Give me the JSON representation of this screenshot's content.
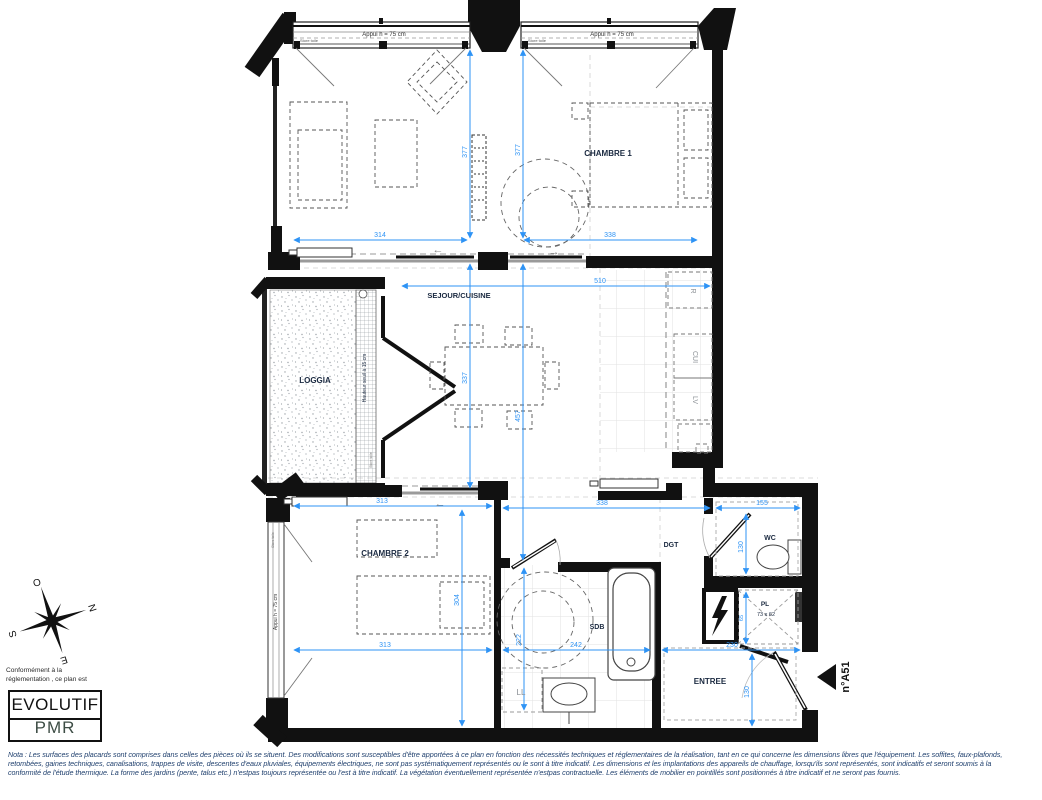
{
  "plan": {
    "marker": "n°A51"
  },
  "rooms": {
    "chambre1": "CHAMBRE 1",
    "sejour": "SEJOUR/CUISINE",
    "loggia": "LOGGIA",
    "chambre2": "CHAMBRE 2",
    "sdb": "SDB",
    "dgt": "DGT",
    "wc": "WC",
    "entree": "ENTREE",
    "placard": "PL",
    "placard_size": "73 x 62"
  },
  "equipment": {
    "fridge": "R",
    "cooktop": "CUI",
    "dishwasher": "LV",
    "washer": "LL"
  },
  "windows": {
    "sill": "Appui h = 75 cm",
    "blind": "Store toile",
    "loggia_threshold": "Hauteur seuil à 15 cm"
  },
  "symbols": {
    "arrow_left": "←",
    "arrow_right": "→"
  },
  "dims": {
    "sejour_part_width": "314",
    "chambre1_width": "338",
    "sejour_part_depth": "377",
    "chambre1_depth": "377",
    "sejour_width": "510",
    "sejour_inner_depth": "337",
    "sejour_depth": "457",
    "chambre2_width": "313",
    "sdb_zone_width": "338",
    "wc_width": "155",
    "wc_depth": "130",
    "chambre2_depth": "304",
    "chambre2_width_bottom": "313",
    "sdb_width": "242",
    "entree_width": "230",
    "sdb_depth": "222",
    "entree_depth": "130",
    "placard_depth": "65"
  },
  "compass": {
    "west": "O",
    "north": "N",
    "south": "S",
    "east": "E"
  },
  "legend": {
    "intro_line1": "Conformément à la",
    "intro_line2": "réglementation , ce plan est",
    "evolutif": "EVOLUTIF",
    "pmr": "PMR"
  },
  "note": {
    "line1": "Nota : Les surfaces des placards sont comprises dans celles des pièces où ils se situent. Des modifications sont susceptibles d'être apportées à ce plan en fonction des nécessités techniques et réglementaires de la réalisation, tant en ce qui concerne les dimensions libres que l'équipement. Les soffites, faux-plafonds,",
    "line2": "retombées, gaines techniques, canalisations, trappes de visite, descentes d'eaux pluviales, équipements électriques, ne sont pas systématiquement représentés ou le sont à titre indicatif. Les dimensions et les implantations des appareils de chauffage, lorsqu'ils sont représentés, sont indicatifs et seront soumis à la",
    "line3": "conformité de l'étude thermique. La forme des jardins (pente, talus etc.) n'estpas toujours représentée ou l'est à titre indicatif. La végétation éventuellement représentée n'estpas contractuelle. Les éléments de mobilier en pointillés sont positionnés à titre indicatif et ne seront pas fournis."
  },
  "colors": {
    "dimension_blue": "#2e93f5",
    "wall_black": "#111111",
    "label_navy": "#1a2940",
    "pmr_green": "#b9d6c6",
    "note_blue": "#20406e"
  }
}
